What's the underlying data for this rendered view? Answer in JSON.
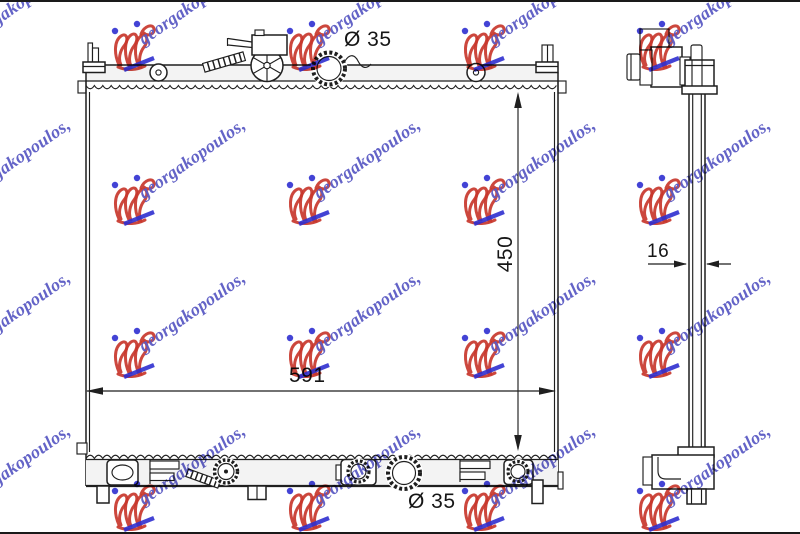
{
  "watermark": {
    "text": "georgakopoulos,",
    "text_color": "#5b5bc4",
    "logo_color": "#c8372d",
    "dot_color": "#2f2fd0",
    "underline_color": "#2f2fd0"
  },
  "drawing": {
    "line_color": "#1f1f1f",
    "front_view": {
      "top_port_diameter": "Ø 35",
      "bottom_port_diameter": "Ø 35",
      "core_height": "450",
      "core_width": "591"
    },
    "side_view": {
      "core_thickness": "16"
    }
  }
}
